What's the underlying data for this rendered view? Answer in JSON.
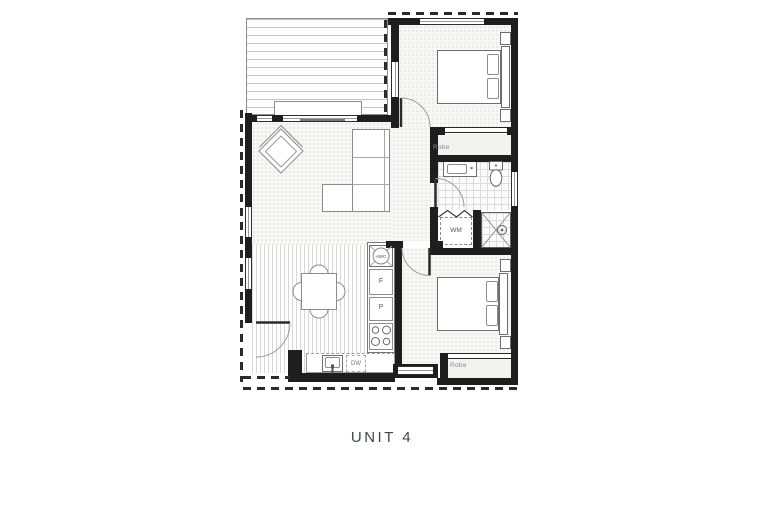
{
  "title": "UNIT 4",
  "labels": {
    "robe_bed1": "Robe",
    "robe_bed2": "Robe",
    "hwc": "HWC",
    "fridge": "F",
    "pantry": "P",
    "washing_machine": "WM",
    "dishwasher": "DW"
  },
  "colors": {
    "wall": "#1e1e1e",
    "roofline_dash": "#2b2b2b",
    "furniture_line": "#6e6e6e",
    "title_text": "#3d4752",
    "label_text": "#8a8a8a"
  }
}
